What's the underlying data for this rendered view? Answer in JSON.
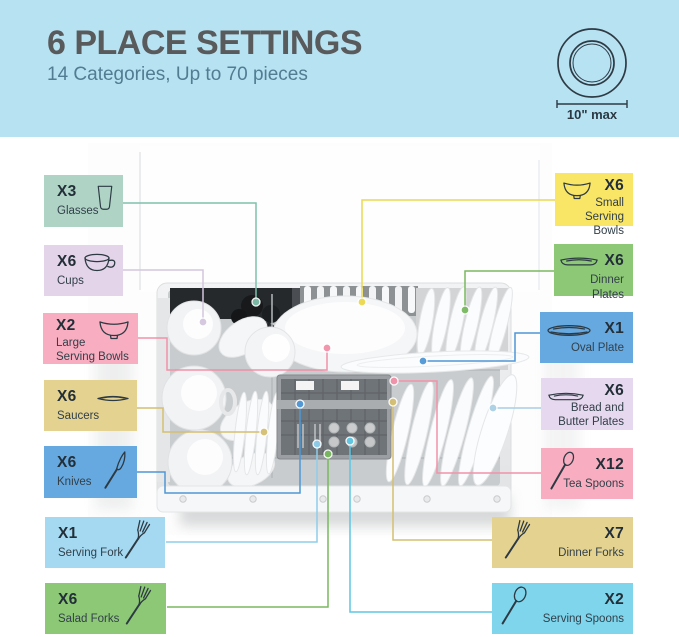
{
  "header": {
    "title": "6 PLACE SETTINGS",
    "subtitle": "14 Categories, Up to 70 pieces",
    "plate_limit": "10\" max",
    "background": "#B7E2F2",
    "title_color": "#595A5C",
    "subtitle_color": "#517C92",
    "plate_icon": "plate-top-view-icon"
  },
  "labels": [
    {
      "id": "glasses",
      "count": "X3",
      "name": "Glasses",
      "icon": "glass-icon",
      "bg": "#AFD4C6",
      "line": "#7FC0AC",
      "side": "left"
    },
    {
      "id": "cups",
      "count": "X6",
      "name": "Cups",
      "icon": "cup-icon",
      "bg": "#E3D4EA",
      "line": "#D3C6DE",
      "side": "left"
    },
    {
      "id": "large-serving-bowls",
      "count": "X2",
      "name": "Large\nServing Bowls",
      "icon": "bowl-icon",
      "bg": "#F8AEC0",
      "line": "#F291A9",
      "side": "left"
    },
    {
      "id": "saucers",
      "count": "X6",
      "name": "Saucers",
      "icon": "saucer-icon",
      "bg": "#E4D290",
      "line": "#D4BF71",
      "side": "left"
    },
    {
      "id": "knives",
      "count": "X6",
      "name": "Knives",
      "icon": "knife-icon",
      "bg": "#66A9E0",
      "line": "#4F97D6",
      "side": "left"
    },
    {
      "id": "serving-fork",
      "count": "X1",
      "name": "Serving Fork",
      "icon": "fork-icon",
      "bg": "#A5D9F1",
      "line": "#8FCDEA",
      "side": "left"
    },
    {
      "id": "salad-forks",
      "count": "X6",
      "name": "Salad Forks",
      "icon": "fork-icon",
      "bg": "#8DC876",
      "line": "#79B95F",
      "side": "left"
    },
    {
      "id": "small-serving-bowls",
      "count": "X6",
      "name": "Small\nServing Bowls",
      "icon": "bowl-icon",
      "bg": "#F9E666",
      "line": "#ECD94E",
      "side": "right"
    },
    {
      "id": "dinner-plates",
      "count": "X6",
      "name": "Dinner Plates",
      "icon": "plate-icon",
      "bg": "#8DC876",
      "line": "#79B95F",
      "side": "right"
    },
    {
      "id": "oval-plate",
      "count": "X1",
      "name": "Oval Plate",
      "icon": "oval-plate-icon",
      "bg": "#66A9E0",
      "line": "#4F97D6",
      "side": "right"
    },
    {
      "id": "bread-and-butter-plates",
      "count": "X6",
      "name": "Bread and\nButter Plates",
      "icon": "plate-icon",
      "bg": "#E6D8EE",
      "line": "#A9CFE4",
      "side": "right"
    },
    {
      "id": "tea-spoons",
      "count": "X12",
      "name": "Tea Spoons",
      "icon": "spoon-icon",
      "bg": "#F8AEC0",
      "line": "#F291A9",
      "side": "right"
    },
    {
      "id": "dinner-forks",
      "count": "X7",
      "name": "Dinner Forks",
      "icon": "fork-icon",
      "bg": "#E4D290",
      "line": "#D4BF71",
      "side": "right"
    },
    {
      "id": "serving-spoons",
      "count": "X2",
      "name": "Serving Spoons",
      "icon": "spoon-icon",
      "bg": "#7ED5EC",
      "line": "#5EC6E2",
      "side": "right"
    }
  ]
}
